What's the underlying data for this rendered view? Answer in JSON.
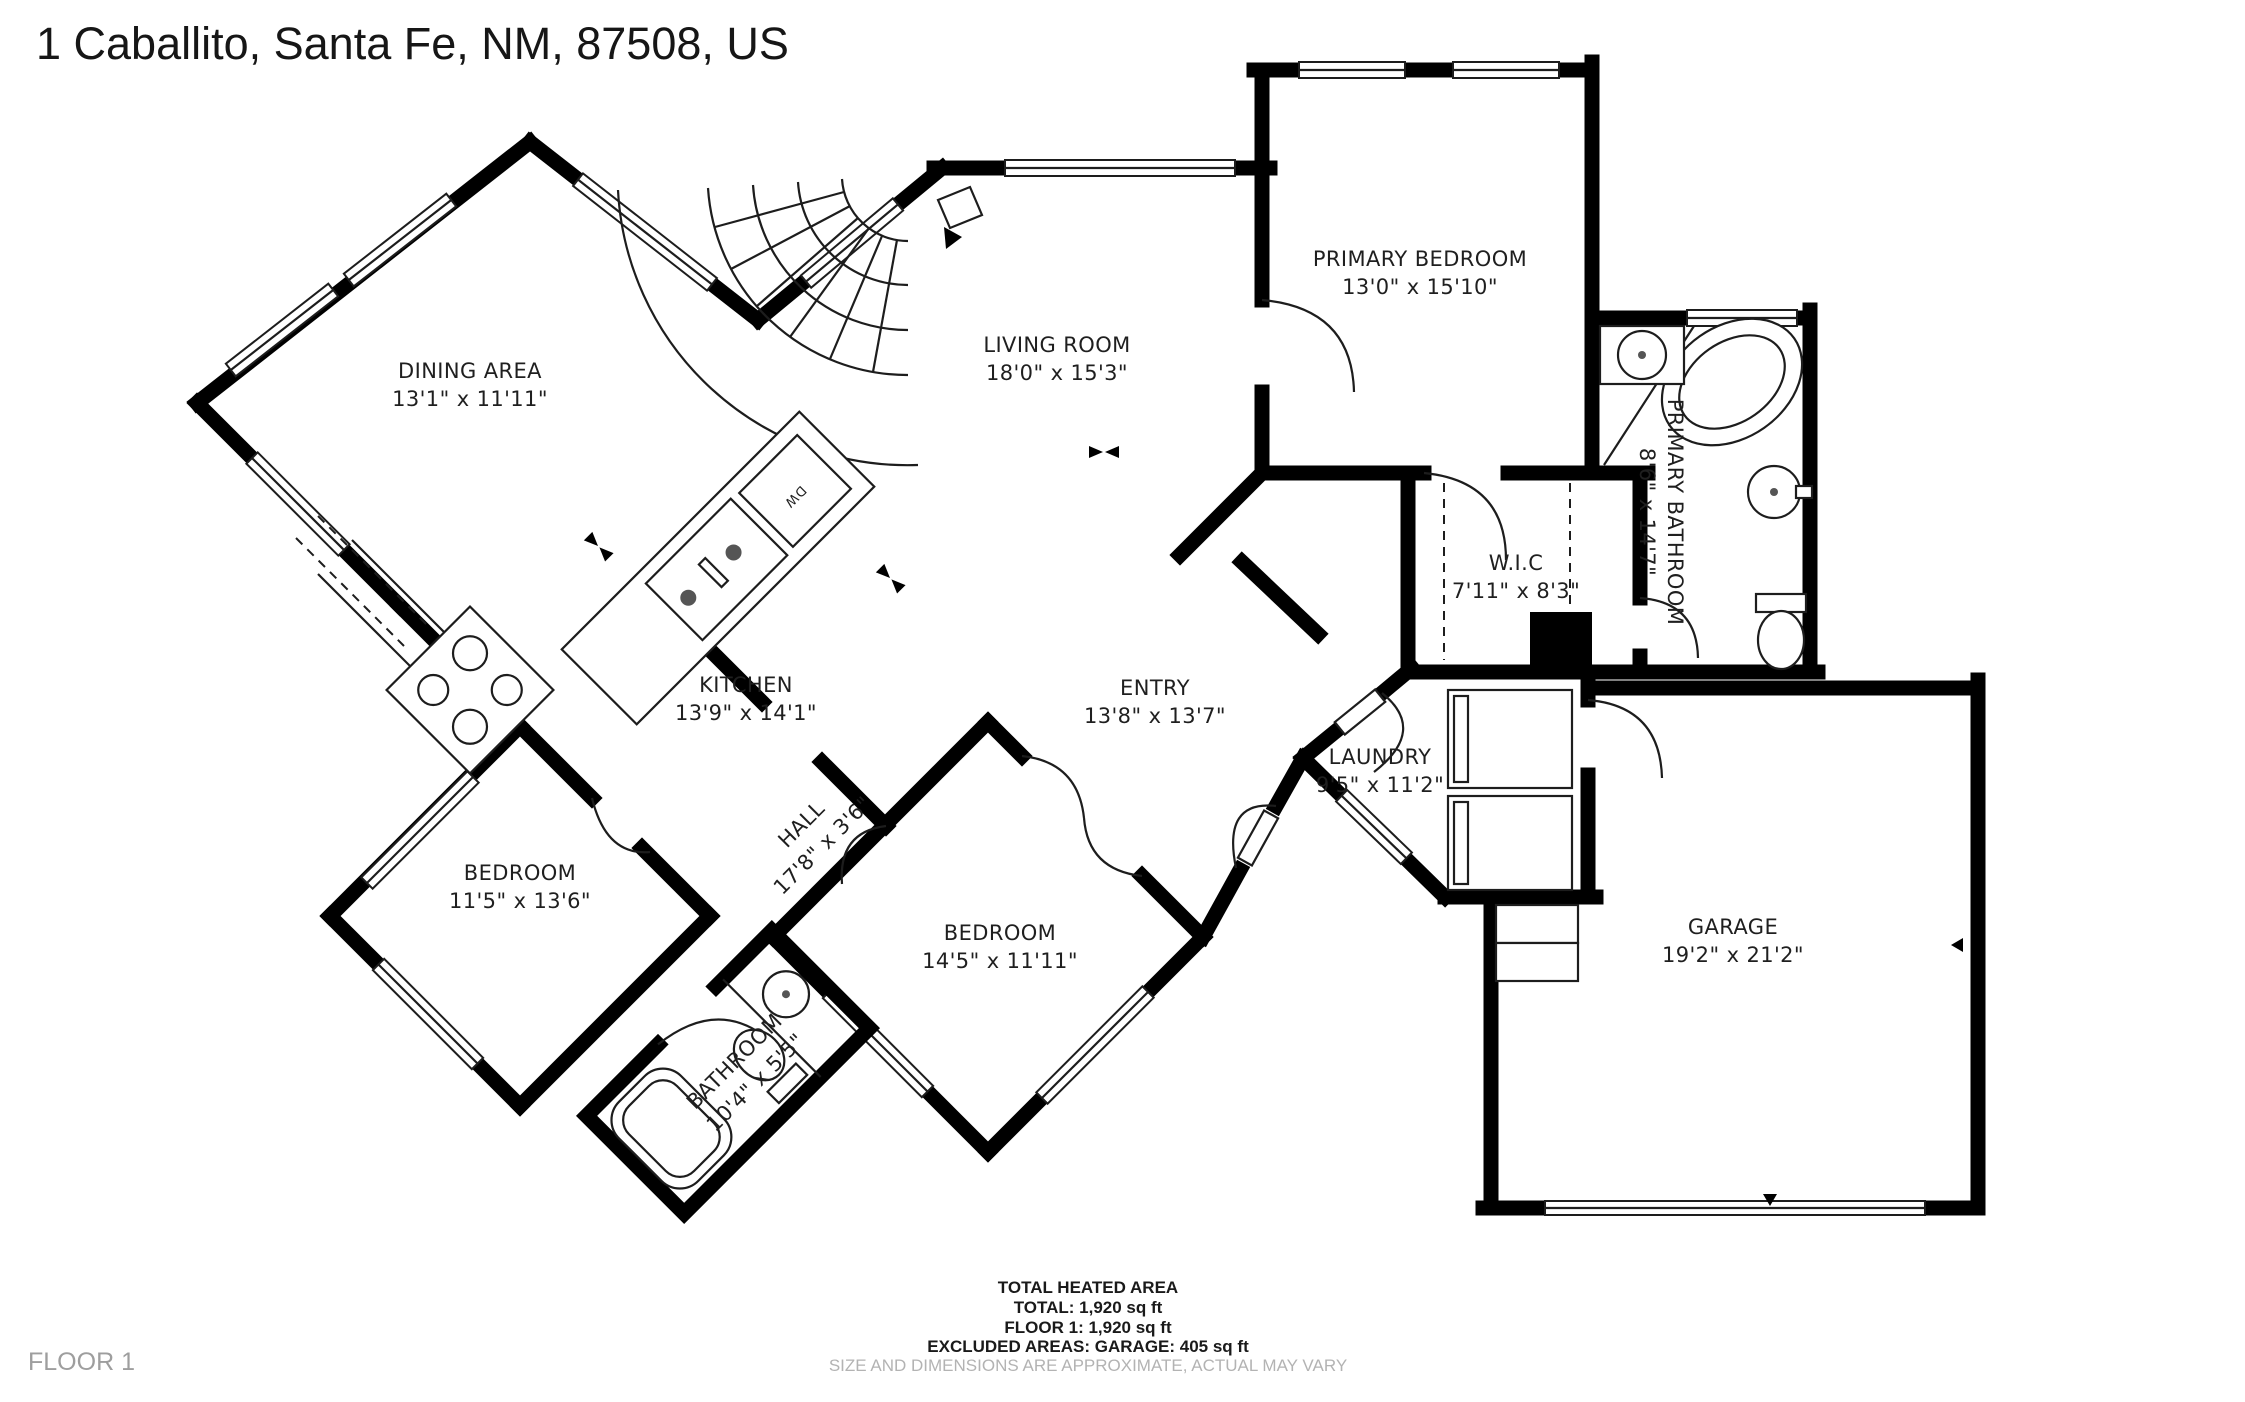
{
  "header": {
    "title": "1 Caballito, Santa Fe, NM, 87508, US"
  },
  "floor_label": "FLOOR 1",
  "rooms": [
    {
      "name": "DINING AREA",
      "dims": "13'1\" x 11'11\""
    },
    {
      "name": "LIVING ROOM",
      "dims": "18'0\" x 15'3\""
    },
    {
      "name": "PRIMARY BEDROOM",
      "dims": "13'0\" x 15'10\""
    },
    {
      "name": "PRIMARY BATHROOM",
      "dims": "8'6\" x 14'7\""
    },
    {
      "name": "W.I.C",
      "dims": "7'11\" x 8'3\""
    },
    {
      "name": "KITCHEN",
      "dims": "13'9\" x 14'1\""
    },
    {
      "name": "ENTRY",
      "dims": "13'8\" x 13'7\""
    },
    {
      "name": "LAUNDRY",
      "dims": "9'5\" x 11'2\""
    },
    {
      "name": "BEDROOM",
      "dims": "11'5\" x 13'6\""
    },
    {
      "name": "BEDROOM",
      "dims": "14'5\" x 11'11\""
    },
    {
      "name": "GARAGE",
      "dims": "19'2\" x 21'2\""
    },
    {
      "name": "HALL",
      "dims": "17'8\" x 3'6\""
    },
    {
      "name": "BATHROOM",
      "dims": "10'4\" x 5'5\""
    }
  ],
  "fixtures": {
    "dishwasher_label": "DW"
  },
  "footer": {
    "line1": "TOTAL HEATED AREA",
    "line2": "TOTAL: 1,920 sq ft",
    "line3": "FLOOR 1: 1,920 sq ft",
    "line4": "EXCLUDED AREAS: GARAGE: 405 sq ft",
    "disclaimer": "SIZE AND DIMENSIONS ARE APPROXIMATE, ACTUAL MAY VARY"
  }
}
